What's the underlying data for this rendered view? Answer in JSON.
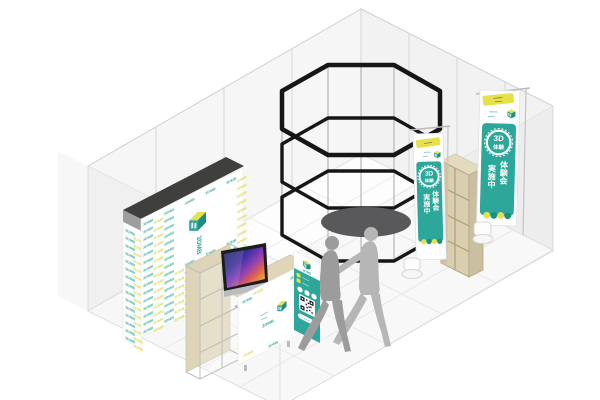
{
  "brand": {
    "name": "3DMB"
  },
  "colors": {
    "teal": "#2EA79B",
    "teal_dark": "#1E8D82",
    "yellow": "#E5E04B",
    "pattern_teal": "#35ADA0",
    "pattern_yellow": "#DED94A",
    "beige": "#D9CFAE",
    "beige_dark": "#C9BFA0",
    "frame_black": "#161616",
    "wall_gray": "#F5F5F5",
    "cap_dark": "#3F3F3D",
    "mat_gray": "#59595B",
    "silhouette_front": "#9C9C9C",
    "silhouette_back": "#B6B6B6"
  },
  "backdrop": {
    "pattern_text": "3DMB",
    "logo_text": "3DMB"
  },
  "banner_small": {
    "ribbon_text": "••••••••",
    "tagline1": "•••••••",
    "tagline2": "•••••",
    "circle_line1": "3D",
    "circle_line2": "体験",
    "vertical_line1": "体験会",
    "vertical_line2": "実施中"
  },
  "banner_large": {
    "ribbon_line1": "•••••••••",
    "ribbon_line2": "•••••••",
    "tagline1": "••••••••",
    "tagline2": "••••••",
    "circle_line1": "3D",
    "circle_line2": "体験",
    "vertical_line1": "体験会",
    "vertical_line2": "実施中"
  },
  "counter_sign": {
    "tagline1": "••••••••",
    "tagline2": "••••••",
    "logo_text": "3DMB"
  },
  "qr_panel": {
    "header_logo_text": "3DMB",
    "feature1": "•••••••",
    "feature2": "•••••••",
    "pill_text": "••••••"
  }
}
